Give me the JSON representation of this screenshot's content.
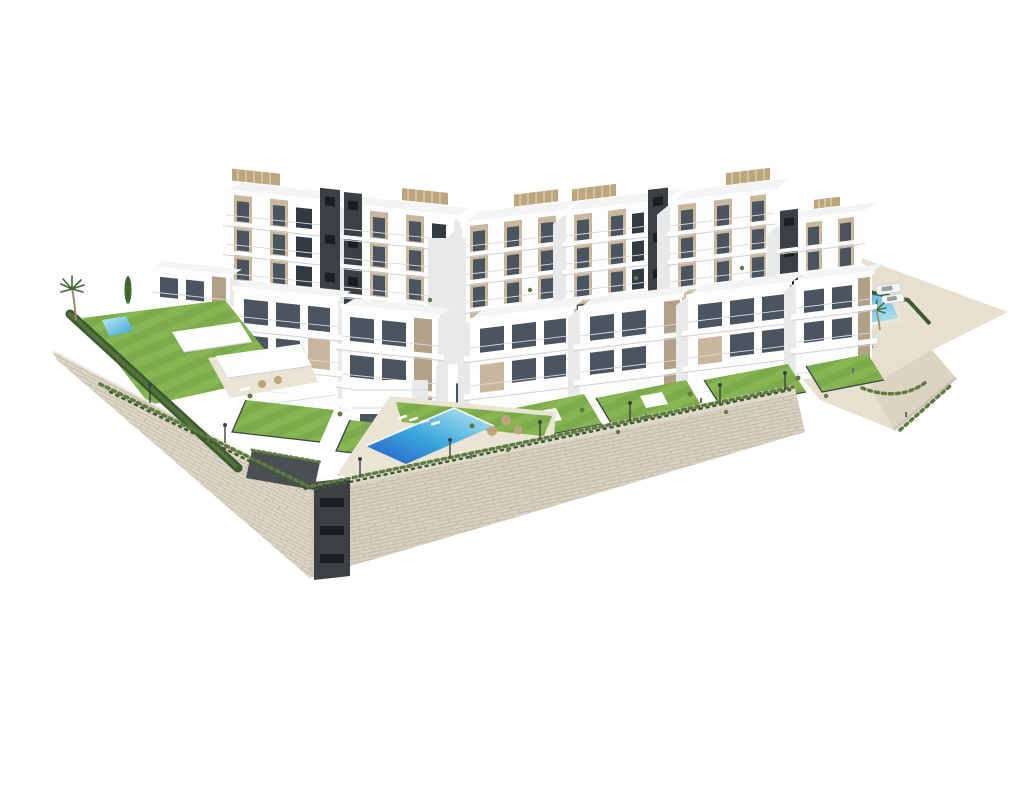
{
  "scene": {
    "type": "3d-architectural-render",
    "description": "Aerial render of a modern white hillside apartment complex on stone retaining walls, white studio background",
    "elements": [
      "white apartment blocks with beige window panels",
      "dark charcoal stair cores",
      "rooftop pergolas with tan slats",
      "central communal infinity pool with sun loungers and parasols",
      "small garden pool on left lawn",
      "terrace pool on right sandy plateau",
      "private unit lawns with dark fences",
      "cypress hedge along left boundary",
      "shrubs trailing over retaining wall",
      "stone masonry retaining wall",
      "service shaft in wall",
      "street lamps",
      "two parked white cars",
      "palm trees",
      "tiny human figures"
    ]
  },
  "colors": {
    "background": "#ffffff",
    "building_white": "#fdfdfd",
    "building_side": "#e8e9eb",
    "building_shade": "#cfd1d3",
    "roof": "#f3f4f5",
    "panel_beige": "#c8b79c",
    "panel_beige_dark": "#b2a186",
    "window_glass": "#4a5560",
    "window_dark": "#323b44",
    "core_dark": "#3b4044",
    "core_slit": "#1b1e21",
    "pergola_tan": "#bda67c",
    "lawn_green": "#7cab4b",
    "lawn_light": "#8dbd58",
    "hedge_green": "#3d5a30",
    "shrub_green": "#5e7c41",
    "sand": "#e7e0cf",
    "sand_shade": "#dcd4c0",
    "stone_wall": "#ddd6c7",
    "stone_line": "#c2b9a6",
    "pool_deep": "#2857c9",
    "pool_mid": "#38a6db",
    "pool_light": "#bfe9f3",
    "deck_cream": "#eae4d5",
    "path_light": "#dfd9ca",
    "fence_dark": "#3f4448",
    "lamp_dark": "#3c4145",
    "car_body": "#f6f7f8",
    "car_glass": "#97a0a7",
    "palm_green": "#41682f",
    "trunk_brown": "#9b8a6b",
    "people": "#6b7075"
  }
}
